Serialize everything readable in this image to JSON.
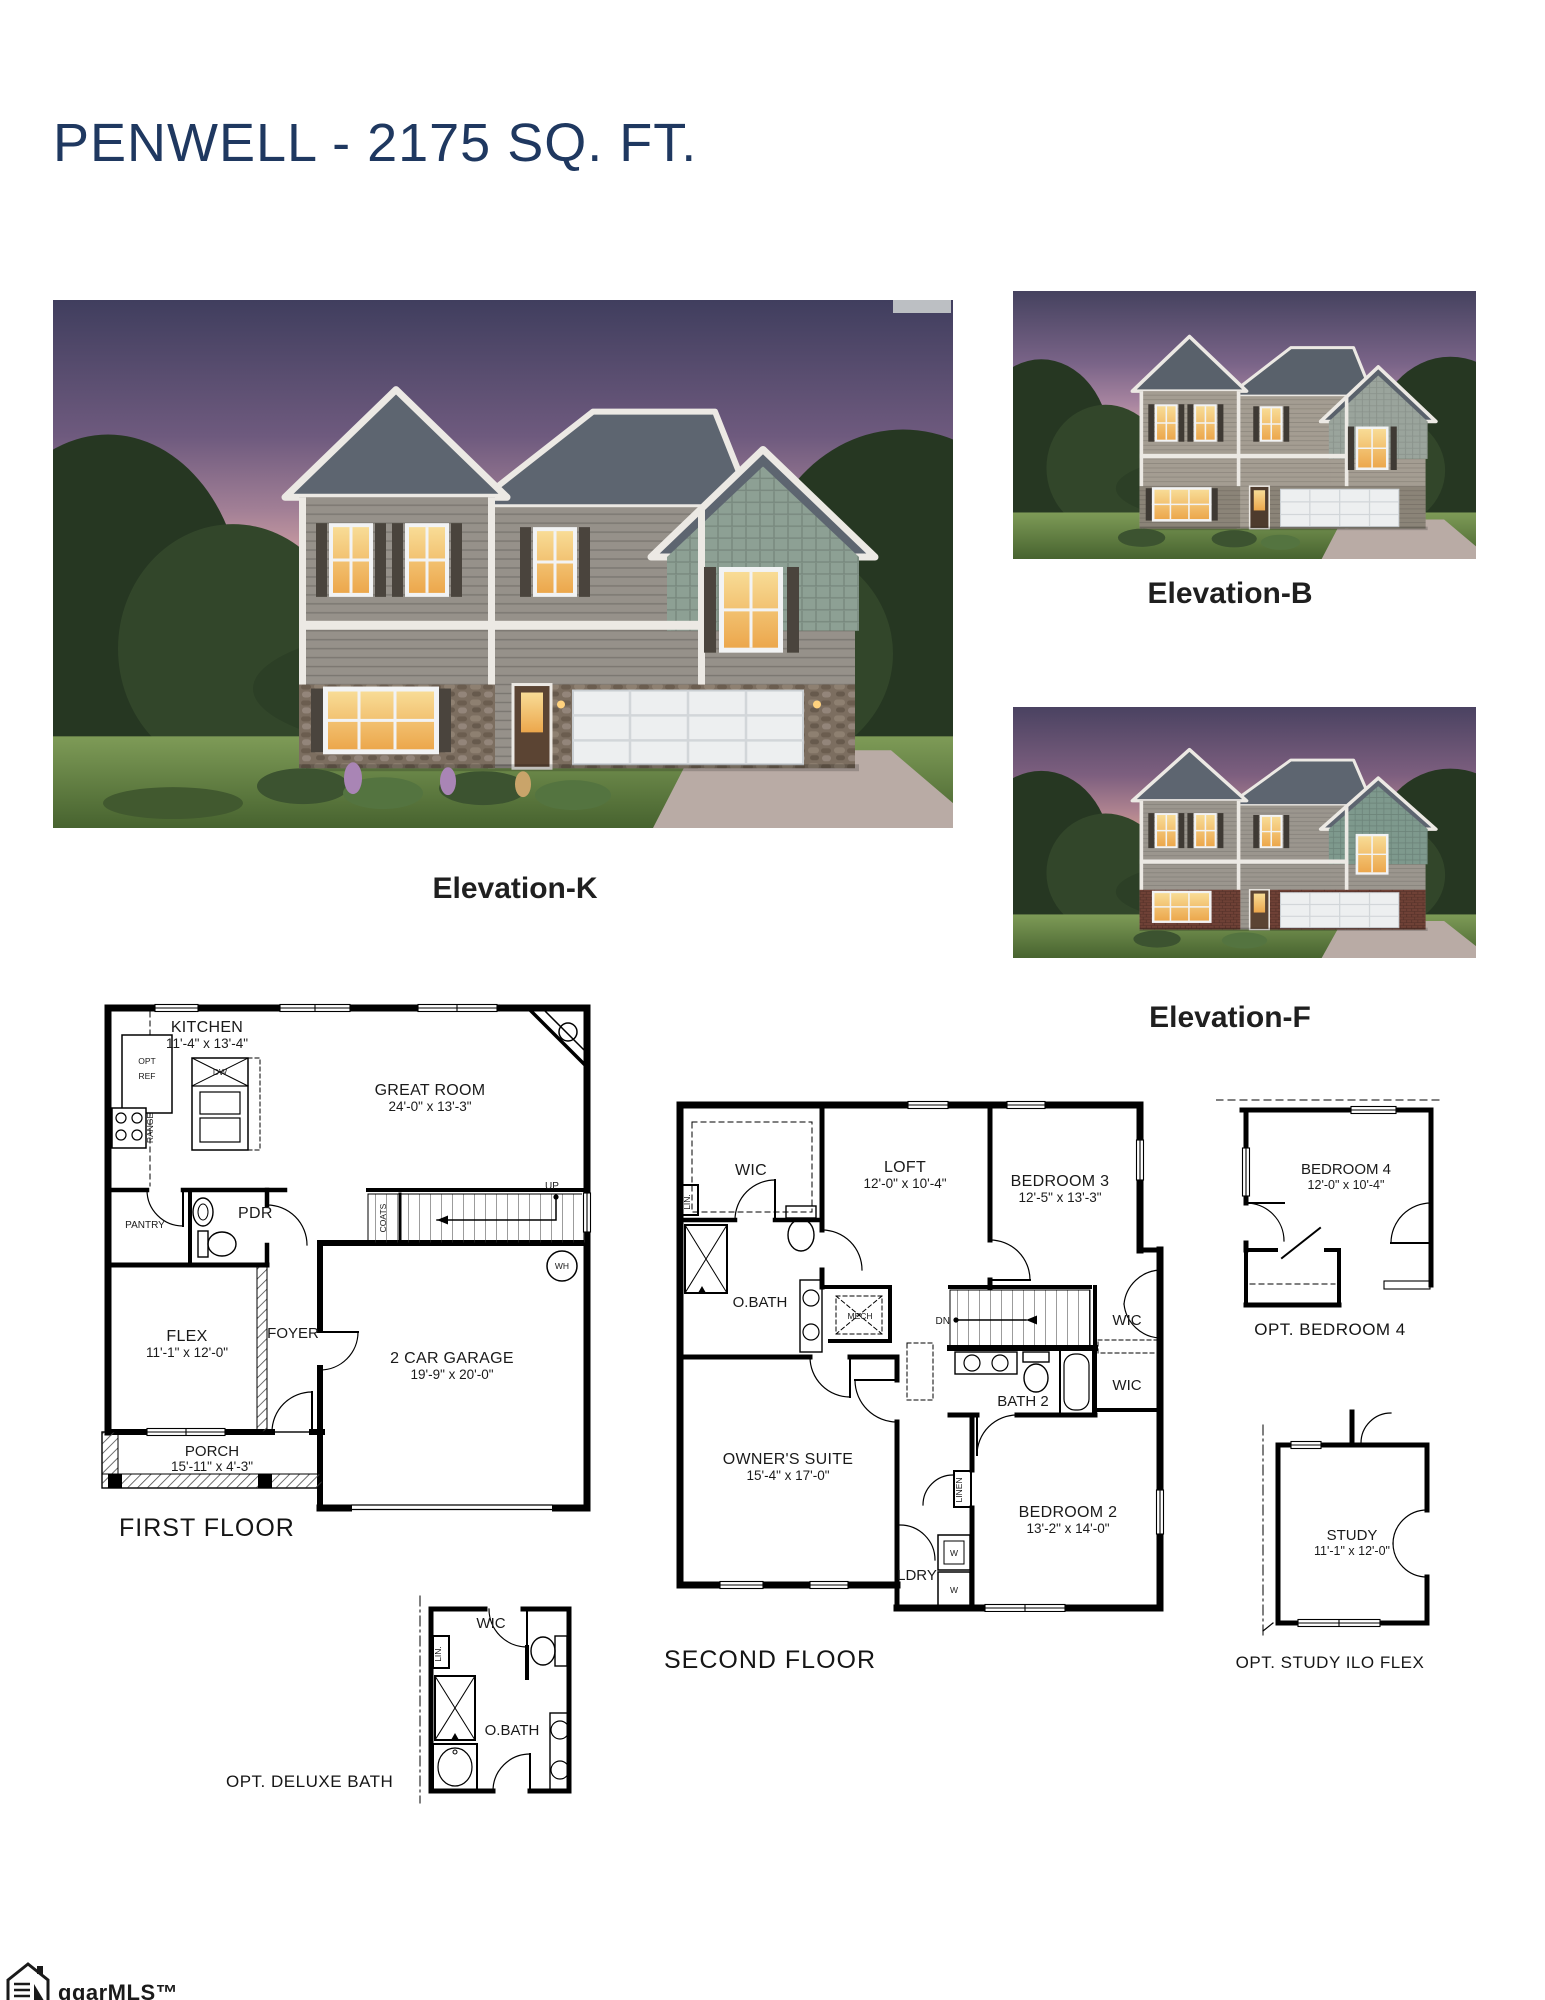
{
  "page": {
    "title": "PENWELL - 2175 SQ. FT."
  },
  "colors": {
    "title_navy": "#1f3860",
    "plan_line": "#000000",
    "label_black": "#1d1d1d",
    "dusk_sky": "#6e5a7e",
    "lawn_green": "#5d7c40",
    "warm_window": "#f3c56a"
  },
  "elevations": [
    {
      "label": "Elevation-K"
    },
    {
      "label": "Elevation-B"
    },
    {
      "label": "Elevation-F"
    }
  ],
  "floor_plans": {
    "first": {
      "caption": "FIRST FLOOR",
      "rooms": [
        {
          "label": "KITCHEN",
          "dims": "11'-4\" x 13'-4\""
        },
        {
          "label": "GREAT ROOM",
          "dims": "24'-0\" x 13'-3\""
        },
        {
          "label": "FLEX",
          "dims": "11'-1\" x 12'-0\""
        },
        {
          "label": "2 CAR GARAGE",
          "dims": "19'-9\" x 20'-0\""
        },
        {
          "label": "PORCH",
          "dims": "15'-11\" x 4'-3\""
        }
      ],
      "labels": {
        "pantry": "PANTRY",
        "pdr": "PDR",
        "foyer": "FOYER",
        "opt_ref_1": "OPT",
        "opt_ref_2": "REF",
        "range": "RANGE",
        "dw": "DW",
        "coats": "COATS",
        "up": "UP",
        "wh": "WH"
      }
    },
    "second": {
      "caption": "SECOND FLOOR",
      "rooms": [
        {
          "label": "LOFT",
          "dims": "12'-0\" x 10'-4\""
        },
        {
          "label": "BEDROOM 3",
          "dims": "12'-5\" x 13'-3\""
        },
        {
          "label": "OWNER'S SUITE",
          "dims": "15'-4\" x 17'-0\""
        },
        {
          "label": "BEDROOM 2",
          "dims": "13'-2\" x 14'-0\""
        }
      ],
      "labels": {
        "wic_owner": "WIC",
        "obath": "O.BATH",
        "lin": "LIN.",
        "mech": "MECH",
        "dn": "DN",
        "wic_upper": "WIC",
        "wic_lower": "WIC",
        "bath2": "BATH 2",
        "linen": "LINEN",
        "ldry": "LDRY",
        "washer": "W",
        "dryer": "W"
      }
    },
    "opt_bedroom4": {
      "caption": "OPT. BEDROOM 4",
      "room": {
        "label": "BEDROOM 4",
        "dims": "12'-0\" x 10'-4\""
      }
    },
    "opt_study": {
      "caption": "OPT. STUDY ILO FLEX",
      "room": {
        "label": "STUDY",
        "dims": "11'-1\" x 12'-0\""
      }
    },
    "opt_deluxe_bath": {
      "caption": "OPT. DELUXE BATH",
      "labels": {
        "wic": "WIC",
        "obath": "O.BATH",
        "lin": "LIN."
      }
    }
  },
  "watermark": {
    "text": "ggarMLS™"
  }
}
